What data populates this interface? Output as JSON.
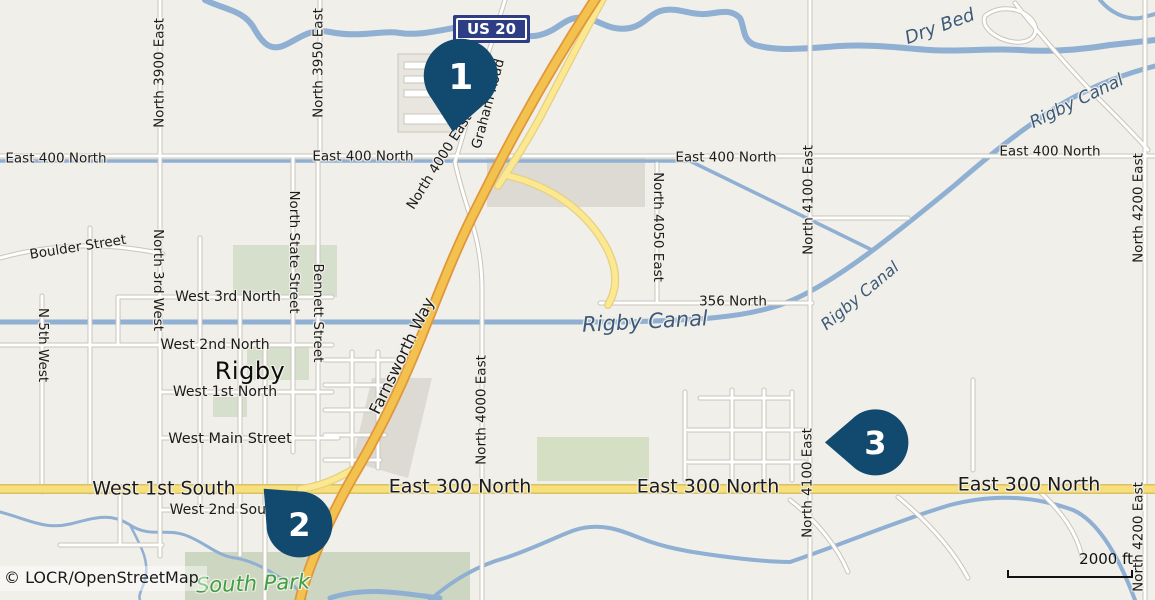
{
  "map": {
    "attribution": "© LOCR/OpenStreetMap",
    "scale_label": "2000 ft",
    "shield_label": "US 20",
    "colors": {
      "background": "#f1efe9",
      "marker": "#114a6e",
      "shield_blue": "#2e3e85",
      "water": "#8fafd3",
      "water_text": "#3b5a7a",
      "park_fill": "#d6decc",
      "park_text": "#3f9e3f",
      "highway_fill": "#f3c14e",
      "highway_casing": "#e0973a",
      "secondary_fill": "#f7df7b",
      "ramp_fill": "#fbe88f",
      "road_fill": "#ffffff",
      "road_casing": "#c9c5bb"
    },
    "markers": [
      {
        "number": "1",
        "x": 461,
        "y": 76,
        "r": 37,
        "rotation": 8,
        "font": 36
      },
      {
        "number": "2",
        "x": 299,
        "y": 524,
        "r": 33,
        "rotation": 135,
        "font": 32
      },
      {
        "number": "3",
        "x": 875,
        "y": 442,
        "r": 33,
        "rotation": 90,
        "font": 32
      }
    ],
    "labels": [
      {
        "text": "East 400 North",
        "x": 56,
        "y": 159,
        "rot": 0,
        "size": 13.5,
        "kind": "street"
      },
      {
        "text": "East 400 North",
        "x": 363,
        "y": 157,
        "rot": 0,
        "size": 13.5,
        "kind": "street"
      },
      {
        "text": "East 400 North",
        "x": 726,
        "y": 158,
        "rot": 0,
        "size": 13.5,
        "kind": "street"
      },
      {
        "text": "East 400 North",
        "x": 1050,
        "y": 152,
        "rot": 0,
        "size": 13.5,
        "kind": "street"
      },
      {
        "text": "North 3900 East",
        "x": 160,
        "y": 73,
        "rot": -90,
        "size": 13.5,
        "kind": "street"
      },
      {
        "text": "North 3950 East",
        "x": 319,
        "y": 63,
        "rot": -90,
        "size": 13.5,
        "kind": "street"
      },
      {
        "text": "Graham Road",
        "x": 489,
        "y": 104,
        "rot": -75,
        "size": 13.5,
        "kind": "street"
      },
      {
        "text": "North 4000 East",
        "x": 440,
        "y": 162,
        "rot": -58,
        "size": 13.5,
        "kind": "street"
      },
      {
        "text": "North 4050 East",
        "x": 657,
        "y": 227,
        "rot": 90,
        "size": 13.5,
        "kind": "street"
      },
      {
        "text": "North 4100 East",
        "x": 809,
        "y": 200,
        "rot": -90,
        "size": 13.5,
        "kind": "street"
      },
      {
        "text": "North 4100 East",
        "x": 808,
        "y": 483,
        "rot": -90,
        "size": 13.5,
        "kind": "street"
      },
      {
        "text": "North 4200 East",
        "x": 1139,
        "y": 208,
        "rot": -90,
        "size": 13.5,
        "kind": "street"
      },
      {
        "text": "North 4200 East",
        "x": 1139,
        "y": 537,
        "rot": -90,
        "size": 13.5,
        "kind": "street"
      },
      {
        "text": "North 4000 East",
        "x": 482,
        "y": 410,
        "rot": -90,
        "size": 13.5,
        "kind": "street"
      },
      {
        "text": "Boulder Street",
        "x": 78,
        "y": 248,
        "rot": -9,
        "size": 13.5,
        "kind": "street"
      },
      {
        "text": "North 3rd West",
        "x": 157,
        "y": 280,
        "rot": 90,
        "size": 13.5,
        "kind": "street"
      },
      {
        "text": "N 5th West",
        "x": 42,
        "y": 345,
        "rot": 90,
        "size": 13.5,
        "kind": "street"
      },
      {
        "text": "North State Street",
        "x": 293,
        "y": 252,
        "rot": 90,
        "size": 13.5,
        "kind": "street"
      },
      {
        "text": "Bennett Street",
        "x": 317,
        "y": 313,
        "rot": 90,
        "size": 13.5,
        "kind": "street"
      },
      {
        "text": "West 3rd North",
        "x": 228,
        "y": 297,
        "rot": 0,
        "size": 14,
        "kind": "street"
      },
      {
        "text": "West 2nd North",
        "x": 215,
        "y": 345,
        "rot": 0,
        "size": 14,
        "kind": "street"
      },
      {
        "text": "West 1st North",
        "x": 225,
        "y": 392,
        "rot": 0,
        "size": 14,
        "kind": "street"
      },
      {
        "text": "West Main Street",
        "x": 230,
        "y": 439,
        "rot": 0,
        "size": 14.5,
        "kind": "street"
      },
      {
        "text": "West 2nd South",
        "x": 225,
        "y": 510,
        "rot": 0,
        "size": 14,
        "kind": "street"
      },
      {
        "text": "356 North",
        "x": 733,
        "y": 302,
        "rot": 0,
        "size": 13.5,
        "kind": "street"
      },
      {
        "text": "Farnsworth Way",
        "x": 402,
        "y": 356,
        "rot": -64,
        "size": 16,
        "kind": "street"
      },
      {
        "text": "West 1st South",
        "x": 164,
        "y": 489,
        "rot": 0,
        "size": 19,
        "kind": "street"
      },
      {
        "text": "East 300 North",
        "x": 460,
        "y": 487,
        "rot": 0,
        "size": 19,
        "kind": "street"
      },
      {
        "text": "East 300 North",
        "x": 708,
        "y": 487,
        "rot": 0,
        "size": 19,
        "kind": "street"
      },
      {
        "text": "East 300 North",
        "x": 1029,
        "y": 485,
        "rot": 0,
        "size": 19,
        "kind": "street"
      },
      {
        "text": "Rigby",
        "x": 250,
        "y": 371,
        "rot": 0,
        "size": 24,
        "kind": "city"
      },
      {
        "text": "Dry Bed",
        "x": 940,
        "y": 27,
        "rot": -20,
        "size": 18,
        "kind": "water"
      },
      {
        "text": "Rigby Canal",
        "x": 1077,
        "y": 102,
        "rot": -26,
        "size": 17,
        "kind": "water"
      },
      {
        "text": "Rigby Canal",
        "x": 860,
        "y": 296,
        "rot": -40,
        "size": 16,
        "kind": "water"
      },
      {
        "text": "Rigby Canal",
        "x": 645,
        "y": 322,
        "rot": -3,
        "size": 21,
        "kind": "water"
      },
      {
        "text": "South Park",
        "x": 253,
        "y": 584,
        "rot": -2,
        "size": 21,
        "kind": "park"
      }
    ]
  }
}
